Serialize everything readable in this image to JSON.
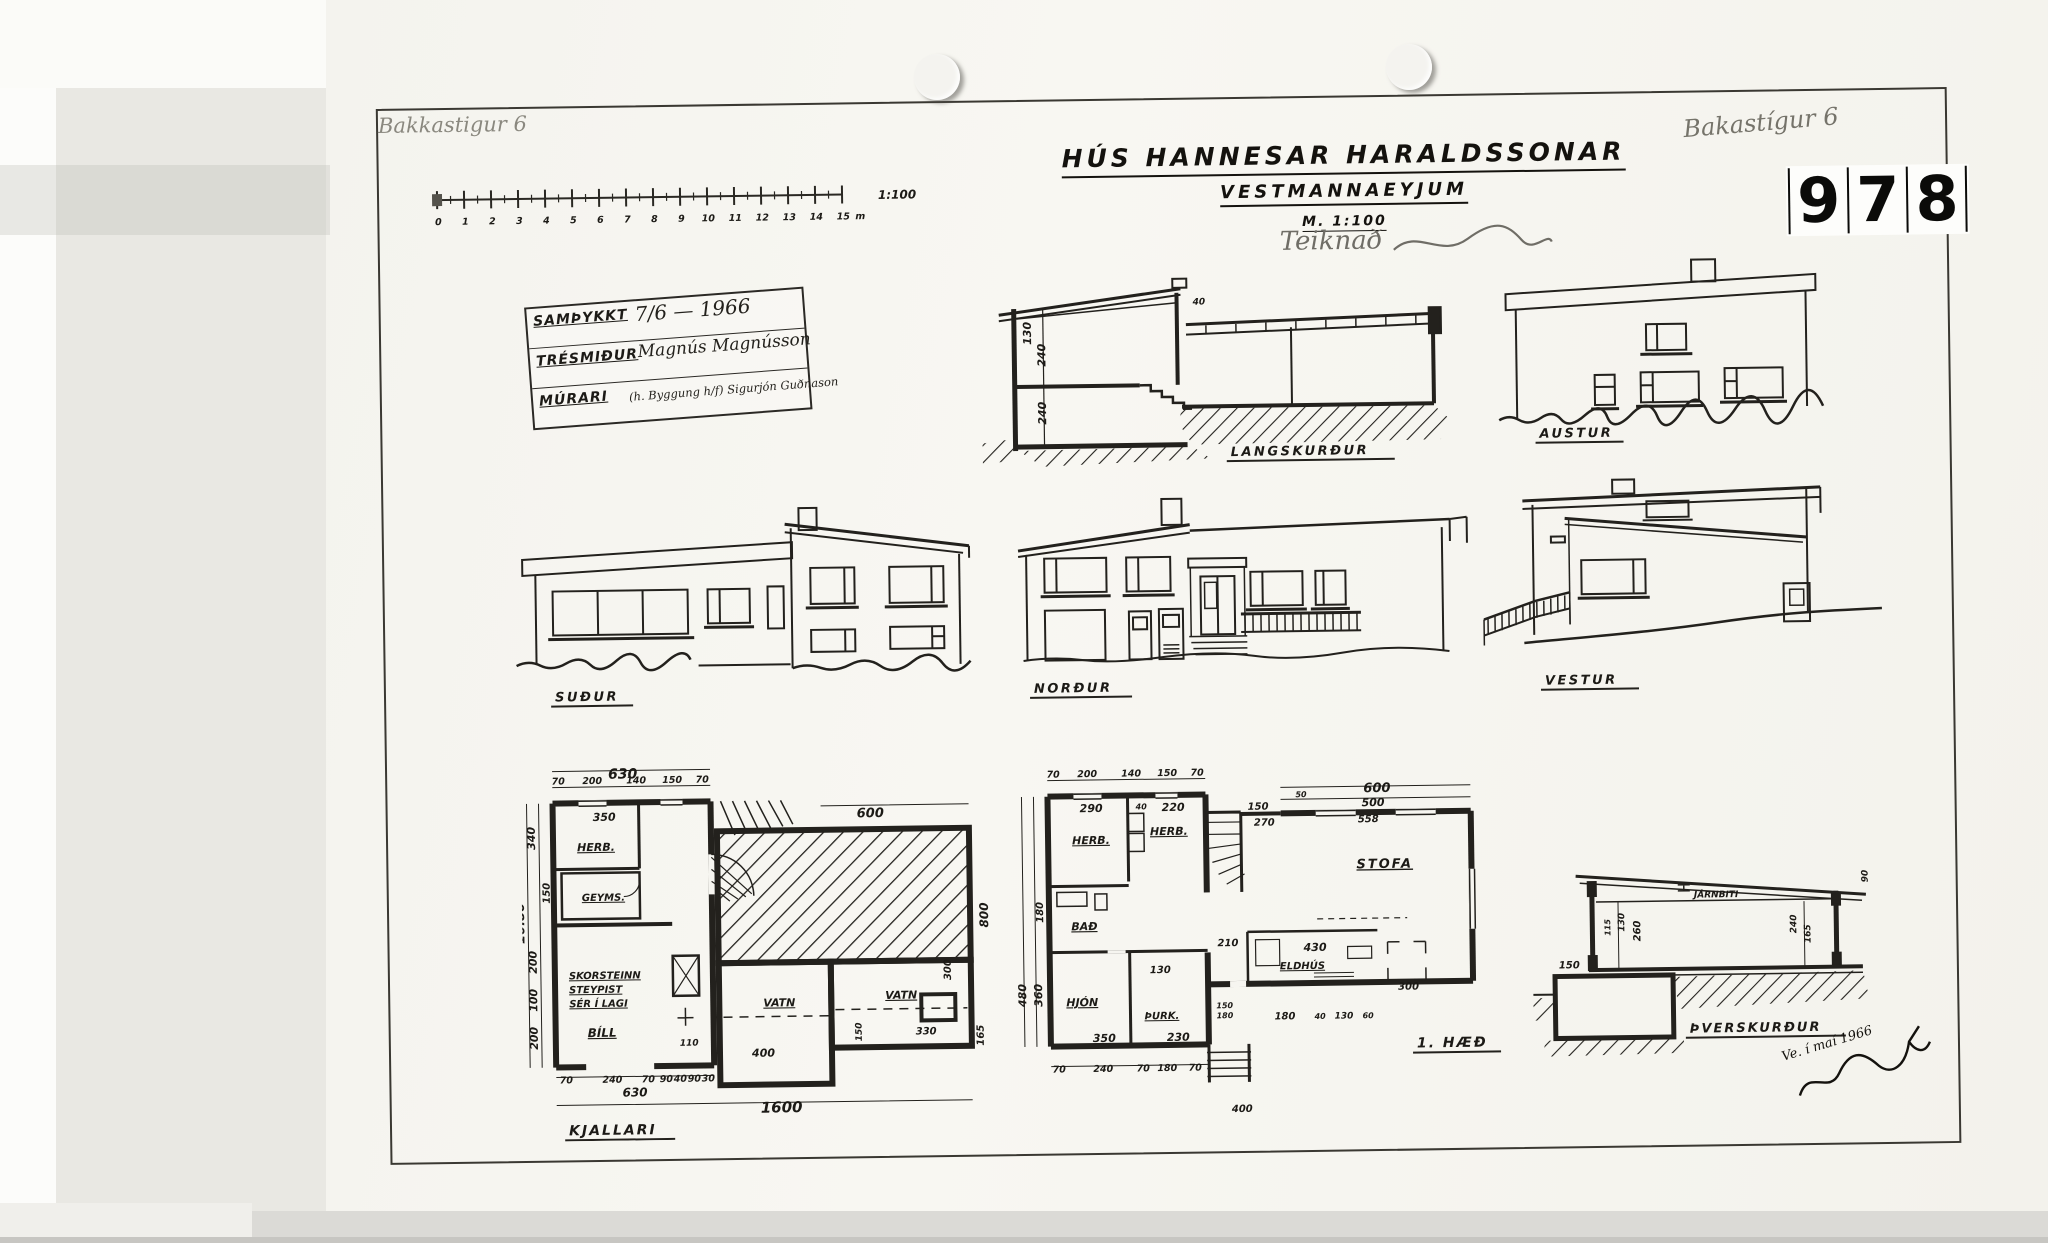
{
  "page": {
    "archive_number_digits": [
      "9",
      "7",
      "8"
    ],
    "pencil_note_top_left": "Bakkastigur 6",
    "pencil_note_top_right": "Bakastígur 6",
    "stray_dim": "400"
  },
  "title_block": {
    "line1": "HÚS HANNESAR HARALDSSONAR",
    "line2": "VESTMANNAEYJUM",
    "scale": "M. 1:100",
    "pencil_annotation": "Teiknað"
  },
  "scale_bar": {
    "ticks": [
      "0",
      "1",
      "2",
      "3",
      "4",
      "5",
      "6",
      "7",
      "8",
      "9",
      "10",
      "11",
      "12",
      "13",
      "14",
      "15"
    ],
    "unit": "m",
    "ratio": "1:100"
  },
  "approval_box": {
    "rows": [
      {
        "label": "SAMÞYKKT",
        "value": "7/6 — 1966"
      },
      {
        "label": "TRÉSMIÐUR",
        "value": "Magnús Magnússon"
      },
      {
        "label": "MÚRARI",
        "value": "(h. Byggung h/f) Sigurjón Guðnason"
      }
    ]
  },
  "sections": {
    "langskurdur": {
      "label": "LANGSKURÐUR",
      "d130": "130",
      "d240a": "240",
      "d240b": "240",
      "d40": "40"
    },
    "thverskurdur": {
      "label": "ÞVERSKURÐUR",
      "beam": "JÁRNBITI",
      "d115": "115",
      "d130": "130",
      "d260": "260",
      "d240": "240",
      "d165": "165",
      "d150": "150",
      "d90": "90"
    }
  },
  "elevations": {
    "austur": "AUSTUR",
    "sudur": "SUÐUR",
    "nordur": "NORÐUR",
    "vestur": "VESTUR"
  },
  "plans": {
    "kjallari": {
      "label": "KJALLARI",
      "rooms": {
        "herb": "HERB.",
        "geyms": "GEYMS.",
        "bill": "BÍLL",
        "vatn1": "VATN",
        "vatn2": "VATN"
      },
      "note1": "SKORSTEINN",
      "note2": "STEYPIST",
      "note3": "SÉR Í LAGI",
      "dims": {
        "w630": "630",
        "top": [
          "70",
          "200",
          "140",
          "150",
          "70"
        ],
        "d350": "350",
        "d340": "340",
        "d150": "150",
        "d200a": "200",
        "d100": "100",
        "d200b": "200",
        "h1080": "10.80",
        "d110": "110",
        "d400": "400",
        "d600": "600",
        "d800": "800",
        "d300": "300",
        "d330": "330",
        "d150b": "150",
        "d165": "165",
        "bottom": [
          "70",
          "240",
          "70",
          "90",
          "40",
          "90",
          "30"
        ],
        "b630": "630",
        "b1600": "1600"
      }
    },
    "haed1": {
      "label": "1. HÆÐ",
      "rooms": {
        "herb1": "HERB.",
        "herb2": "HERB.",
        "bad": "BAÐ",
        "hjon": "HJÓN",
        "thurk": "ÞURK.",
        "stofa": "STOFA",
        "eldhus": "ELDHÚS"
      },
      "dims": {
        "top": [
          "70",
          "200",
          "140",
          "150",
          "70"
        ],
        "d290": "290",
        "d40": "40",
        "d220": "220",
        "d150": "150",
        "d270": "270",
        "d50": "50",
        "d600": "600",
        "d500": "500",
        "d558": "558",
        "d180": "180",
        "d480": "480",
        "d360": "360",
        "d210": "210",
        "d130": "130",
        "d430": "430",
        "k150": "150",
        "k180": "180",
        "r180": "180",
        "r40": "40",
        "r130": "130",
        "r60": "60",
        "d300": "300",
        "d350": "350",
        "d230": "230",
        "bottom": [
          "70",
          "240",
          "70",
          "180",
          "70"
        ]
      }
    }
  },
  "signature": {
    "date": "Ve. í maí 1966"
  }
}
